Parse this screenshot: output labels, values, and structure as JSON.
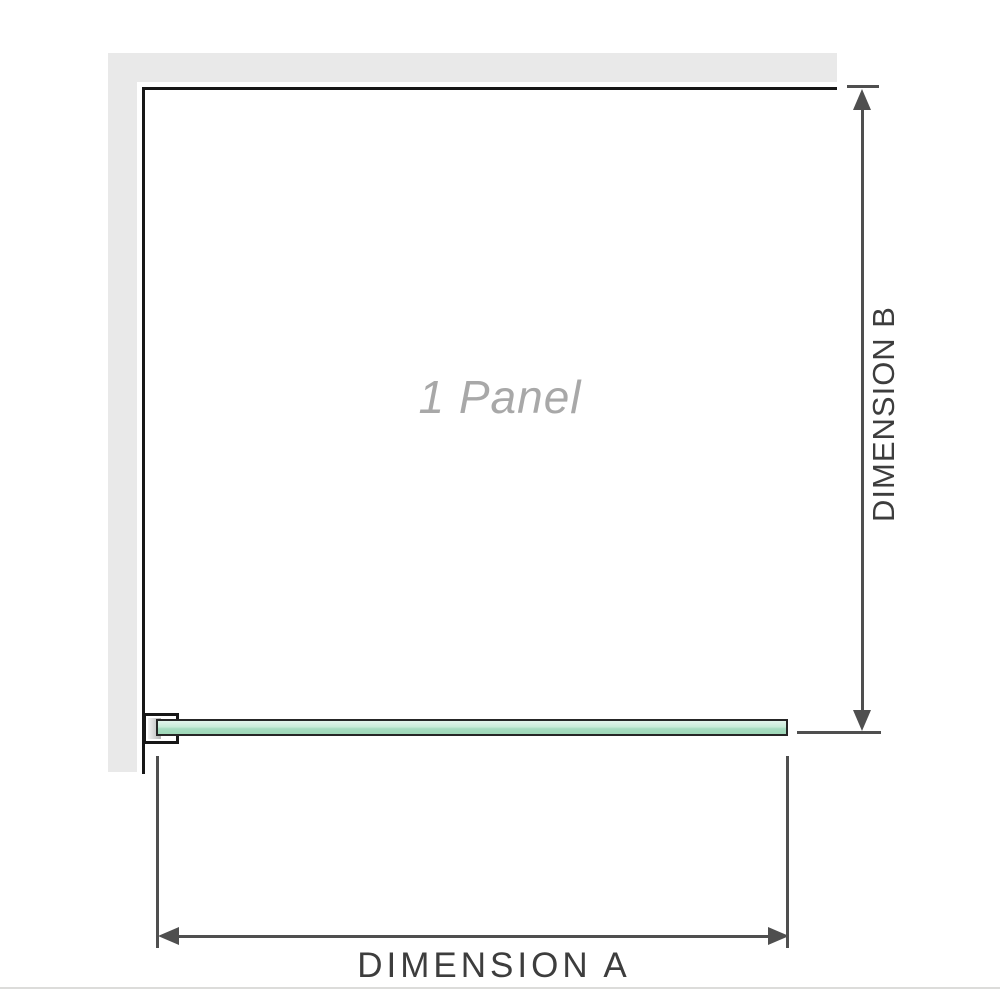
{
  "diagram": {
    "panel_label": "1 Panel",
    "dimension_a_label": "DIMENSION A",
    "dimension_b_label": "DIMENSION B"
  },
  "colors": {
    "wall": "#e9e9e9",
    "outline": "#171717",
    "dimension_line": "#4f4f4f",
    "dimension_label_text": "#3d3d3d",
    "panel_label_text": "#a8a8a8",
    "glass_light": "#e3f5ec",
    "glass_dark": "#9fd8b8"
  }
}
